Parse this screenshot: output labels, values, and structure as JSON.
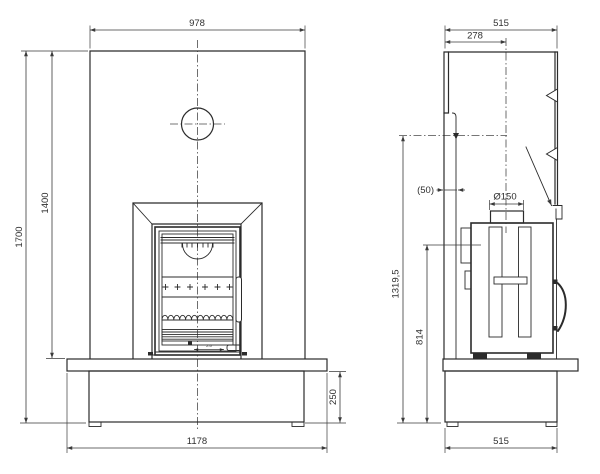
{
  "colors": {
    "background": "#ffffff",
    "line": "#2b2b2b",
    "dimension_line": "#3a3a3a"
  },
  "front_view": {
    "dimensions": {
      "surround_width": "978",
      "overall_height": "1700",
      "surround_height": "1400",
      "base_width": "1178",
      "base_height": "250",
      "door_vent_detail": "2-0"
    }
  },
  "side_view": {
    "dimensions": {
      "overall_depth": "515",
      "flue_centre_offset": "278",
      "wall_clearance": "(50)",
      "flue_diameter": "Ø150",
      "flue_reference_height": "1319,5",
      "rear_outlet_height": "814",
      "base_depth": "515"
    }
  }
}
